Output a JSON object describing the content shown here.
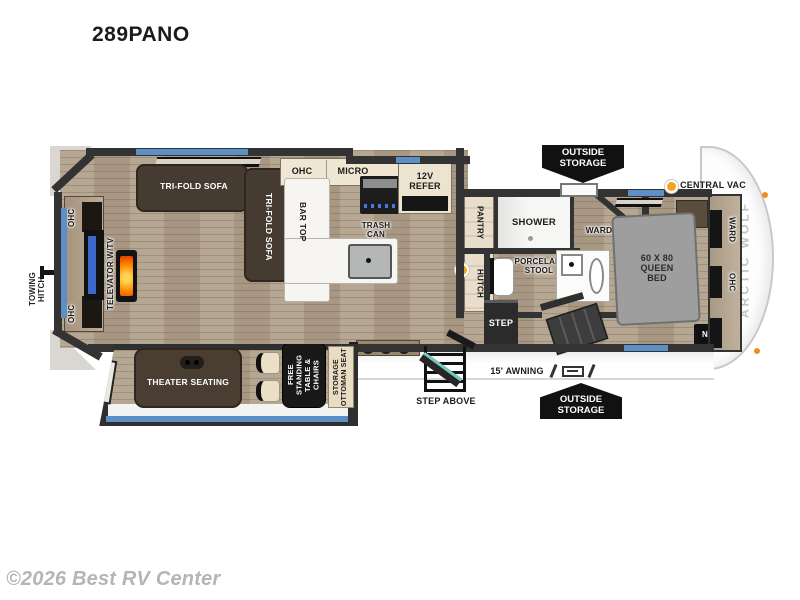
{
  "title": "289PANO",
  "watermark": "©2026 Best RV Center",
  "exterior": {
    "towing_hitch": "TOWING\nHITCH",
    "outside_storage_top": "OUTSIDE\nSTORAGE",
    "outside_storage_bottom": "OUTSIDE\nSTORAGE",
    "central_vac": "CENTRAL VAC",
    "awning": "15' AWNING",
    "step_above": "STEP ABOVE",
    "brand": "ARCTIC WOLF"
  },
  "living": {
    "ohc_top": "OHC",
    "ohc_bottom": "OHC",
    "televator": "TELEVATOR W/TV",
    "sofa_h": "TRI-FOLD SOFA",
    "sofa_v": "TRI-FOLD SOFA",
    "theater": "THEATER SEATING",
    "table": "FREE STANDING\nTABLE & CHAIRS",
    "ottoman": "STORAGE\nOTTOMAN SEAT"
  },
  "kitchen": {
    "ohc": "OHC",
    "micro": "MICRO",
    "refer": "12V\nREFER",
    "bar_top": "BAR TOP",
    "trash": "TRASH\nCAN"
  },
  "bath": {
    "pantry": "PANTRY",
    "shower": "SHOWER",
    "ward": "WARD",
    "hutch": "HUTCH",
    "stool": "PORCELAIN\nSTOOL",
    "step": "STEP"
  },
  "bedroom": {
    "bed": "60 X 80\nQUEEN\nBED",
    "ward": "WARD",
    "ohc": "OHC",
    "ns": "N/S"
  },
  "colors": {
    "wall": "#333333",
    "wood_floor": "#b1a08b",
    "window_accent": "#5b8fc5",
    "badge_bg": "#111111",
    "vac_dot": "#f4a21f",
    "flame": "#ff8a00",
    "tv_screen": "#3d68c9",
    "brand_gray": "#c2c2c2"
  }
}
